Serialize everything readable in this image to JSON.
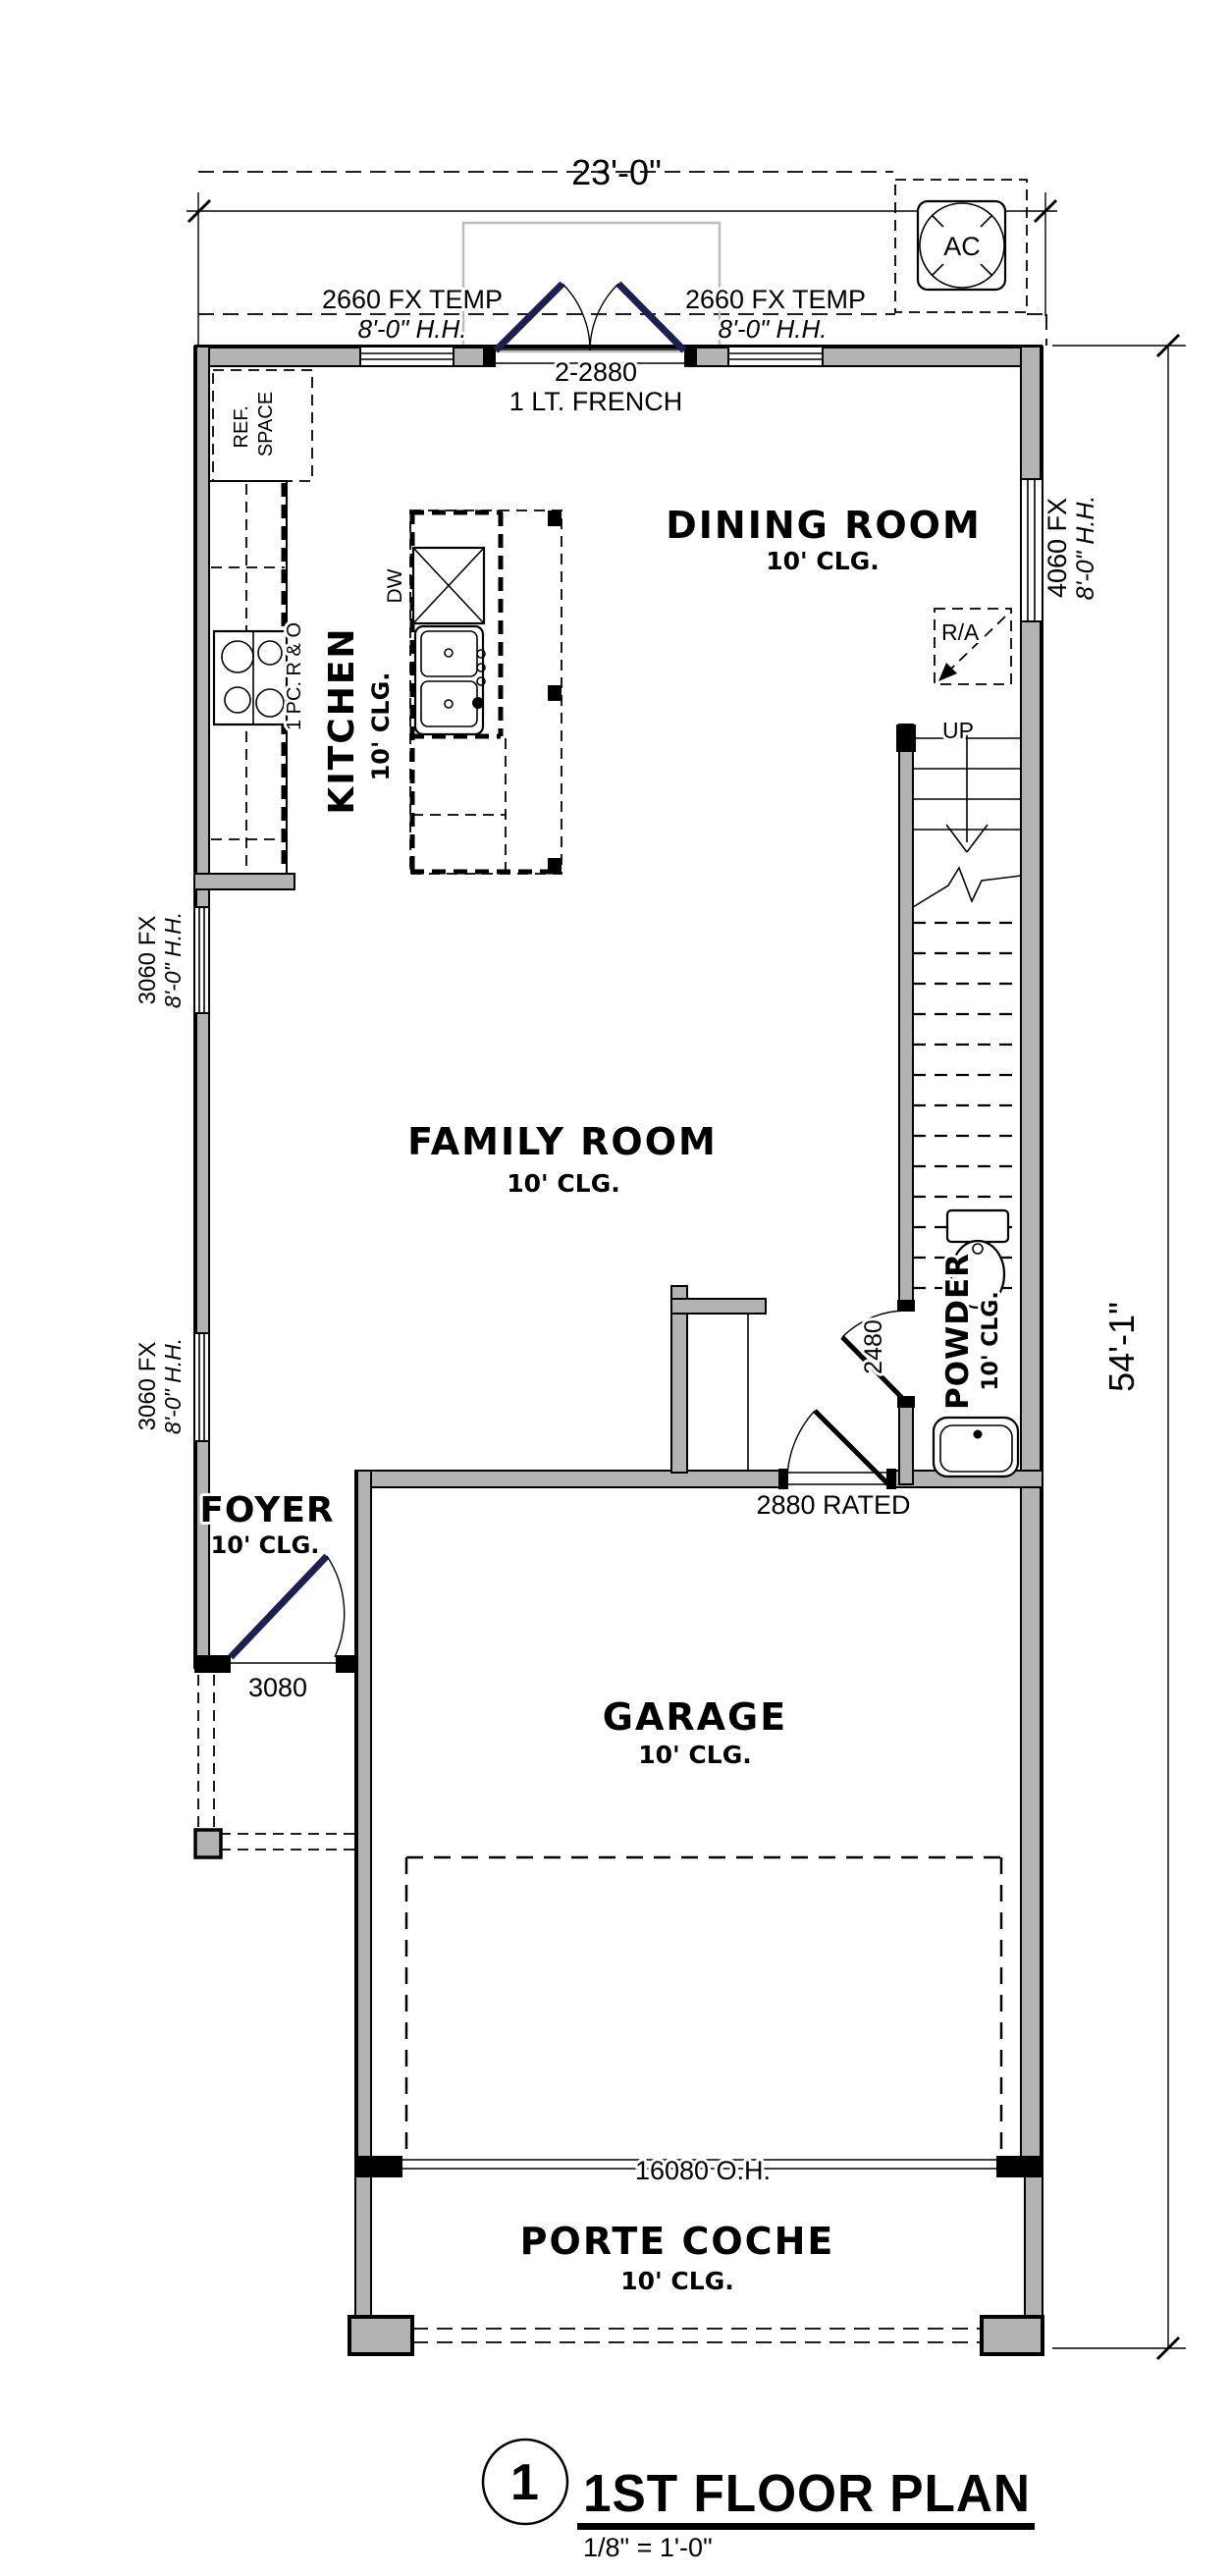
{
  "sheet": {
    "number": "1",
    "title": "1ST FLOOR PLAN",
    "scale": "1/8\" = 1'-0\""
  },
  "dimensions": {
    "overall_width": "23'-0\"",
    "overall_depth": "54'-1\""
  },
  "rooms": {
    "dining": {
      "name": "DINING ROOM",
      "clg": "10' CLG."
    },
    "kitchen": {
      "name": "KITCHEN",
      "clg": "10' CLG."
    },
    "family": {
      "name": "FAMILY ROOM",
      "clg": "10' CLG."
    },
    "foyer": {
      "name": "FOYER",
      "clg": "10' CLG."
    },
    "powder": {
      "name": "POWDER",
      "clg": "10' CLG."
    },
    "garage": {
      "name": "GARAGE",
      "clg": "10' CLG."
    },
    "porte_coche": {
      "name": "PORTE COCHE",
      "clg": "10' CLG."
    }
  },
  "openings": {
    "window_top_left": {
      "size": "2660 FX TEMP",
      "head": "8'-0\" H.H."
    },
    "window_top_right": {
      "size": "2660 FX TEMP",
      "head": "8'-0\" H.H."
    },
    "french_door": {
      "size": "2-2880",
      "type": "1 LT. FRENCH"
    },
    "window_right": {
      "size": "4060 FX",
      "head": "8'-0\" H.H."
    },
    "window_left_upper": {
      "size": "3060 FX",
      "head": "8'-0\" H.H."
    },
    "window_left_lower": {
      "size": "3060 FX",
      "head": "8'-0\" H.H."
    },
    "front_door": {
      "size": "3080"
    },
    "powder_door": {
      "size": "2480"
    },
    "garage_entry_door": {
      "size": "2880 RATED"
    },
    "overhead_door": {
      "size": "16080 O.H."
    }
  },
  "fixtures": {
    "ref": {
      "line1": "REF.",
      "line2": "SPACE"
    },
    "range": "1 PC. R & O",
    "dishwasher": "DW",
    "ac": "AC",
    "return_air": "R/A",
    "stairs": "UP"
  },
  "colors": {
    "wall_fill": "#b3b3b3",
    "door_leaf": "#1b2050",
    "patio_outline": "#bdbdbd"
  }
}
